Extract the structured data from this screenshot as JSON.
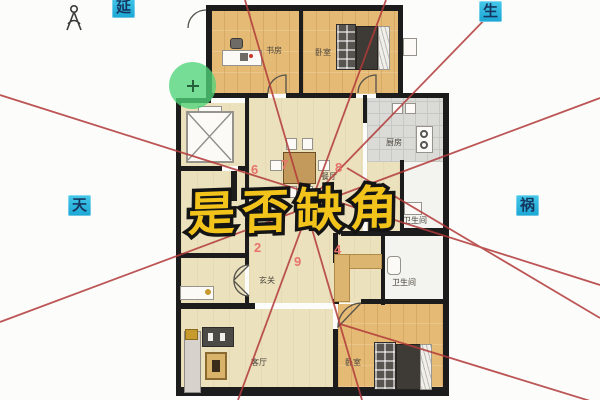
{
  "page": {
    "background": "#fcfcfa"
  },
  "overlay": {
    "title": {
      "text": "是否缺角",
      "fill": "#f2c31b",
      "outline": "#141414"
    },
    "direction_labels": [
      {
        "id": "yan",
        "text": "延"
      },
      {
        "id": "sheng",
        "text": "生"
      },
      {
        "id": "tian",
        "text": "天"
      },
      {
        "id": "huo",
        "text": "祸"
      }
    ],
    "direction_label_colors": {
      "bg": "#29b5de",
      "fg": "#14365f"
    },
    "sector_numbers": [
      {
        "text": "6"
      },
      {
        "text": "7"
      },
      {
        "text": "8"
      },
      {
        "text": "2"
      },
      {
        "text": "9"
      },
      {
        "text": "4"
      }
    ],
    "number_color": "#e8736b",
    "sector_line_color": "#b23a3a"
  },
  "plan": {
    "room_labels": [
      {
        "id": "study",
        "text": "书房"
      },
      {
        "id": "bedroom-top",
        "text": "卧室"
      },
      {
        "id": "kitchen",
        "text": "厨房"
      },
      {
        "id": "bath-upper",
        "text": "卫生间"
      },
      {
        "id": "dining",
        "text": "餐厅"
      },
      {
        "id": "entry",
        "text": "玄关"
      },
      {
        "id": "bath-lower",
        "text": "卫生间"
      },
      {
        "id": "living",
        "text": "客厅"
      },
      {
        "id": "bedroom-bottom",
        "text": "卧室"
      }
    ],
    "palette": {
      "wood_floor": "#e5ba74",
      "pale_floor": "#ebe1bd",
      "kitchen_tile": "#dadad6",
      "bath_floor": "#f3f3ef",
      "wall": "#1c1c1c"
    }
  }
}
